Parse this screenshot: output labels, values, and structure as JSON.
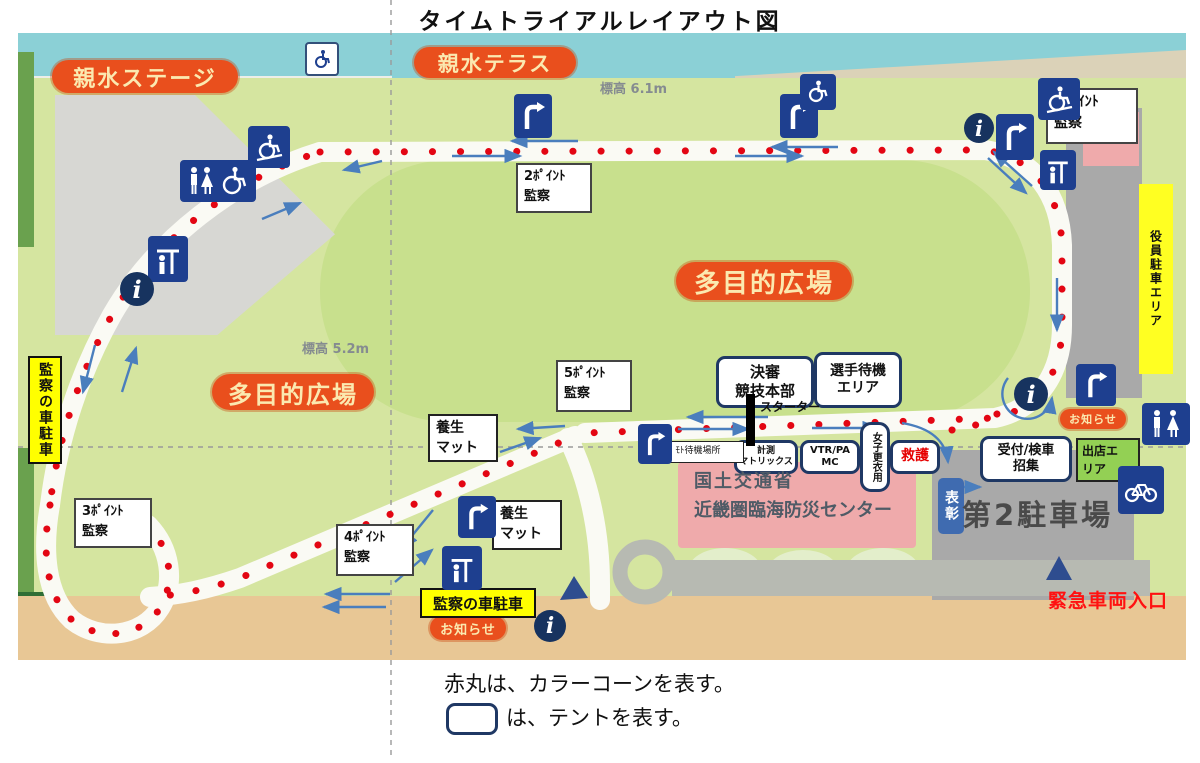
{
  "title": "タイムトライアルレイアウト図",
  "legend": {
    "line1": "赤丸は、カラーコーンを表す。",
    "line2": "は、テントを表す。"
  },
  "areas": {
    "stage": "親水ステージ",
    "terrace": "親水テラス",
    "field_right": "多目的広場",
    "field_left": "多目的広場",
    "elev_top": "標高 6.1m",
    "elev_mid": "標高 5.2m",
    "officials_parking": "役員駐車エリア",
    "parking2": "第2駐車場",
    "building_line1": "国土交通省",
    "building_line2": "近畿圏臨海防災センター",
    "vendor_line1": "出店エ",
    "vendor_line2": "リア",
    "award": "表彰",
    "emergency": "緊急車両入口",
    "notice_right": "お知らせ",
    "notice_bottom": "お知らせ"
  },
  "checkpoints": [
    {
      "line1": "1ﾎﾟｲﾝﾄ",
      "line2": "監察"
    },
    {
      "line1": "2ﾎﾟｲﾝﾄ",
      "line2": "監察"
    },
    {
      "line1": "3ﾎﾟｲﾝﾄ",
      "line2": "監察"
    },
    {
      "line1": "4ﾎﾟｲﾝﾄ",
      "line2": "監察"
    },
    {
      "line1": "5ﾎﾟｲﾝﾄ",
      "line2": "監察"
    }
  ],
  "tents": {
    "hq_line1": "決審",
    "hq_line2": "競技本部",
    "wait_line1": "選手待機",
    "wait_line2": "エリア",
    "timing_line1": "計測",
    "timing_line2": "マトリックス",
    "vtr_line1": "VTR/PA",
    "vtr_line2": "MC",
    "changing": "女子更衣用",
    "firstaid": "救護",
    "reception_line1": "受付/検車",
    "reception_line2": "招集",
    "moto": "ﾓﾄ待機場所"
  },
  "labels": {
    "starter": "スターター",
    "mat1_line1": "養生",
    "mat1_line2": "マット",
    "mat2_line1": "養生",
    "mat2_line2": "マット",
    "marshal_parking_left": "監察の車駐車",
    "marshal_parking_bottom": "監察の車駐車"
  },
  "colors": {
    "cone_red": "#e30613",
    "arrow_blue": "#4a7ebd",
    "pill_orange": "#e94f1d",
    "label_yellow": "#ffff00",
    "sign_navy": "#1e3f8f",
    "tent_border_navy": "#1f3864",
    "vendor_green": "#93d054",
    "award_blue": "#3f6bb0",
    "emergency_red": "#ff1111"
  }
}
